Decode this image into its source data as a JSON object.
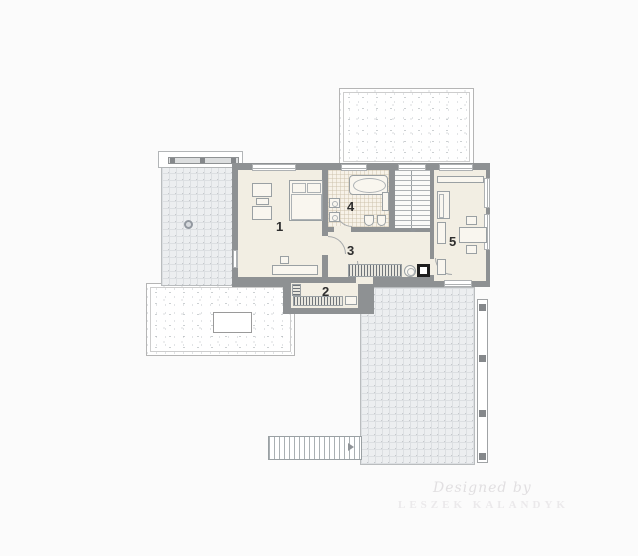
{
  "plan": {
    "type": "architectural-floor-plan",
    "rooms": [
      {
        "number": "1",
        "name": "bedroom"
      },
      {
        "number": "2",
        "name": "wardrobe"
      },
      {
        "number": "3",
        "name": "hall"
      },
      {
        "number": "4",
        "name": "bathroom"
      },
      {
        "number": "5",
        "name": "study"
      }
    ],
    "watermark": {
      "line1": "Designed by",
      "line2": "LESZEK KALANDYK"
    },
    "colors": {
      "wall": "#8e9193",
      "room_floor": "#f2eee3",
      "bath_floor": "#f7f2e8",
      "terrace_tile": "#eceef0",
      "appliance_dark": "#1e1e1e",
      "background": "#fbfbfb"
    }
  }
}
